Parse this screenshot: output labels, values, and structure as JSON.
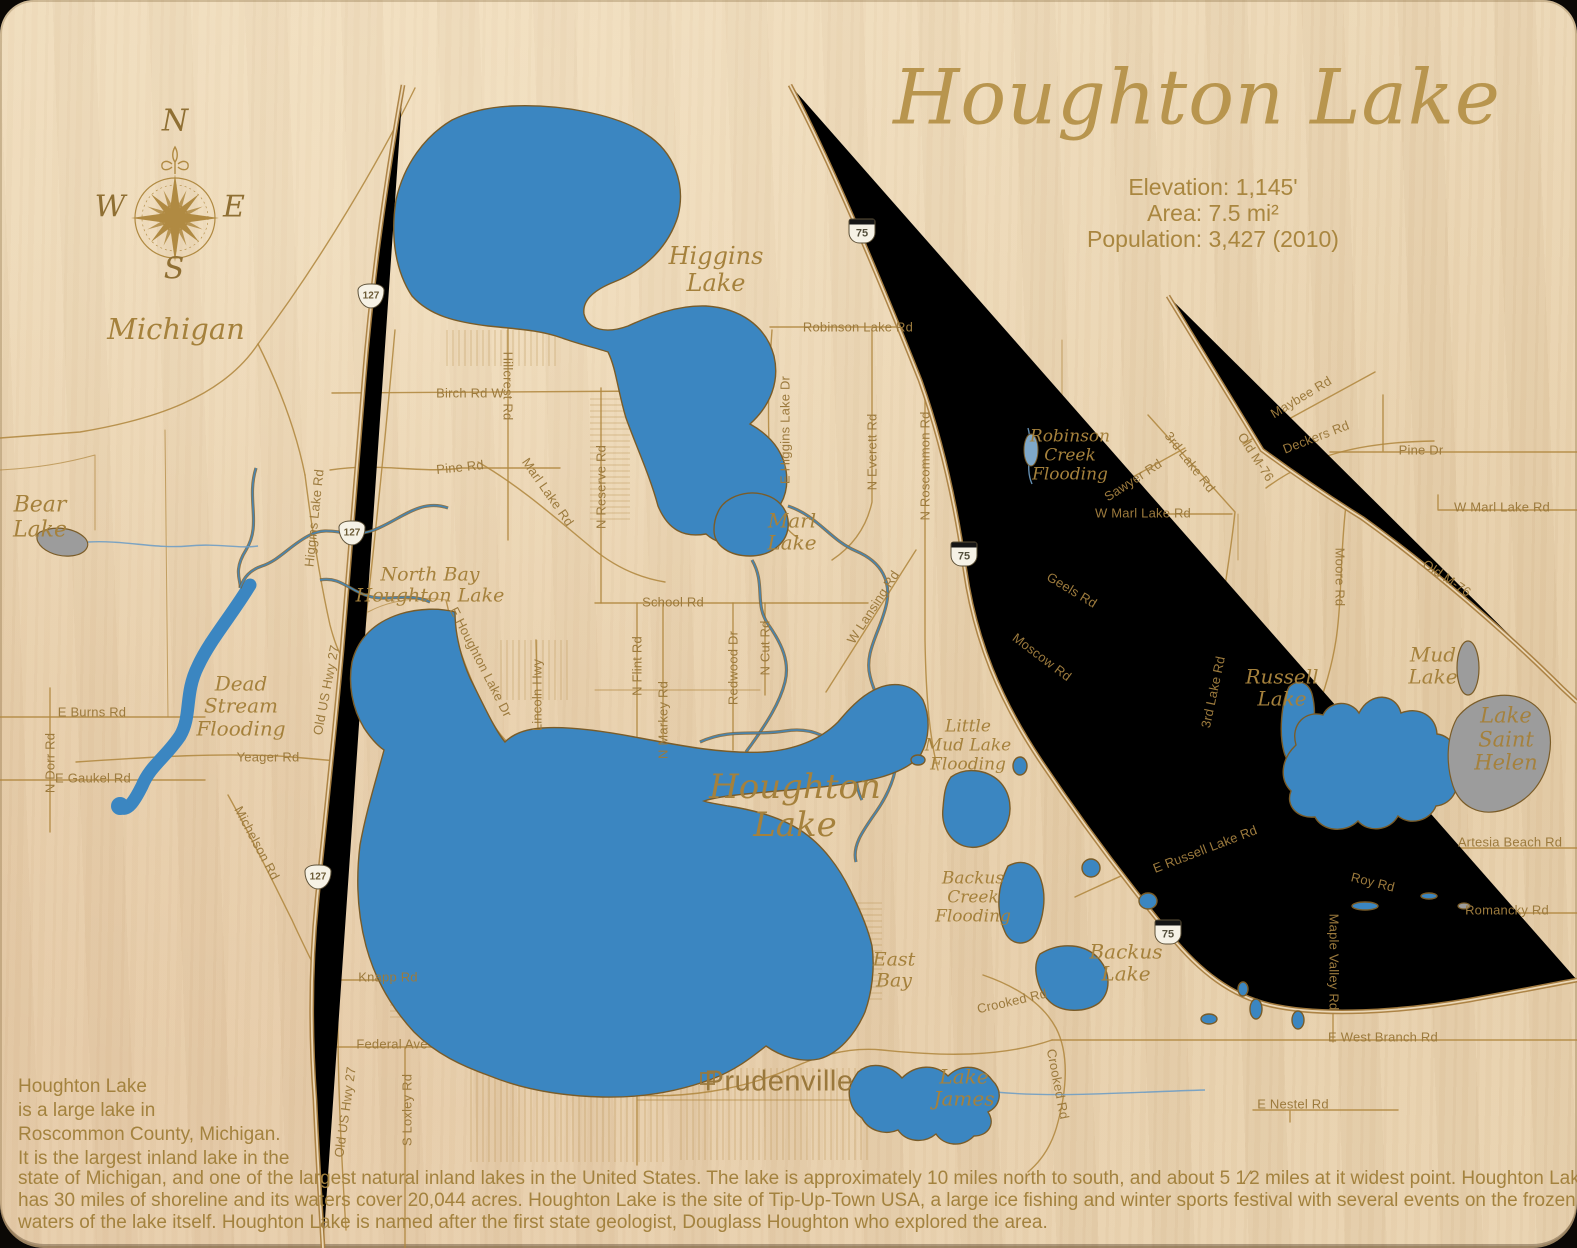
{
  "title": "Houghton Lake",
  "state_label": "Michigan",
  "city_label": "Prudenville",
  "stats": {
    "elevation": "Elevation: 1,145'",
    "area": "Area: 7.5 mi²",
    "population": "Population: 3,427 (2010)"
  },
  "compass": {
    "north": "N",
    "east": "E",
    "south": "S",
    "west": "W"
  },
  "description": {
    "line1": "Houghton Lake",
    "line2": "is a large lake in",
    "line3": "Roscommon County, Michigan.",
    "line4": "It is the largest inland lake in the",
    "line5": "state of Michigan, and one of the largest natural inland lakes in the United States. The lake is approximately 10 miles north to south, and about 5 1⁄2 miles at it widest point. Houghton Lake",
    "line6": "has 30 miles of shoreline and its waters cover 20,044 acres.  Houghton Lake is the site of Tip-Up-Town USA, a large ice fishing and winter sports festival with several events on the frozen",
    "line7": "waters of the lake itself. Houghton Lake is named after the first state geologist, Douglass Houghton who explored the area."
  },
  "colors": {
    "wood": "#e8d2b0",
    "road": "#b1873f",
    "water": "#3b86c1",
    "gray_water": "#9c9c9c",
    "label_gold": "#9c7a3d",
    "title_gold": "#b8954e"
  },
  "road_labels": [
    {
      "text": "Birch Rd W",
      "x": 470,
      "y": 393,
      "rot": 0
    },
    {
      "text": "Hillcrest Rd",
      "x": 508,
      "y": 386,
      "rot": 90
    },
    {
      "text": "Pine Rd",
      "x": 460,
      "y": 467,
      "rot": -6
    },
    {
      "text": "Marl Lake Rd",
      "x": 548,
      "y": 492,
      "rot": 55
    },
    {
      "text": "N Reserve Rd",
      "x": 601,
      "y": 487,
      "rot": -90
    },
    {
      "text": "E Higgins Lake Dr",
      "x": 785,
      "y": 430,
      "rot": -90
    },
    {
      "text": "Robinson Lake Rd",
      "x": 858,
      "y": 327,
      "rot": 0
    },
    {
      "text": "N Everett Rd",
      "x": 872,
      "y": 452,
      "rot": -90
    },
    {
      "text": "N Roscommon Rd",
      "x": 925,
      "y": 466,
      "rot": -90
    },
    {
      "text": "W Lansing Rd",
      "x": 873,
      "y": 607,
      "rot": -57
    },
    {
      "text": "Sawyer Rd",
      "x": 1133,
      "y": 480,
      "rot": -33
    },
    {
      "text": "3rd Lake Rd",
      "x": 1190,
      "y": 462,
      "rot": 52
    },
    {
      "text": "W Marl Lake Rd",
      "x": 1143,
      "y": 513,
      "rot": 0
    },
    {
      "text": "Geels Rd",
      "x": 1072,
      "y": 590,
      "rot": 31
    },
    {
      "text": "Moscow Rd",
      "x": 1042,
      "y": 657,
      "rot": 37
    },
    {
      "text": "Maybee Rd",
      "x": 1301,
      "y": 397,
      "rot": -31
    },
    {
      "text": "Old M-76",
      "x": 1256,
      "y": 457,
      "rot": 57
    },
    {
      "text": "Deckers Rd",
      "x": 1316,
      "y": 437,
      "rot": -21
    },
    {
      "text": "Pine Dr",
      "x": 1421,
      "y": 450,
      "rot": 0
    },
    {
      "text": "W Marl Lake Rd",
      "x": 1502,
      "y": 507,
      "rot": 0
    },
    {
      "text": "Old M-76",
      "x": 1447,
      "y": 578,
      "rot": 34
    },
    {
      "text": "Moore Rd",
      "x": 1340,
      "y": 577,
      "rot": 90
    },
    {
      "text": "3rd Lake Rd",
      "x": 1213,
      "y": 692,
      "rot": -78
    },
    {
      "text": "Higgins Lake Rd",
      "x": 314,
      "y": 518,
      "rot": -84
    },
    {
      "text": "Old US Hwy 27",
      "x": 326,
      "y": 690,
      "rot": -79
    },
    {
      "text": "E Houghton Lake Dr",
      "x": 481,
      "y": 662,
      "rot": 63
    },
    {
      "text": "Lincoln Hwy",
      "x": 537,
      "y": 695,
      "rot": -90
    },
    {
      "text": "N Flint Rd",
      "x": 637,
      "y": 666,
      "rot": -90
    },
    {
      "text": "N Markey Rd",
      "x": 663,
      "y": 720,
      "rot": -90
    },
    {
      "text": "Redwood Dr",
      "x": 733,
      "y": 668,
      "rot": -90
    },
    {
      "text": "N Cut Rd",
      "x": 765,
      "y": 648,
      "rot": -90
    },
    {
      "text": "School Rd",
      "x": 673,
      "y": 602,
      "rot": 0
    },
    {
      "text": "E Burns Rd",
      "x": 92,
      "y": 712,
      "rot": 0
    },
    {
      "text": "N Dorr Rd",
      "x": 50,
      "y": 763,
      "rot": -90
    },
    {
      "text": "E Gaukel Rd",
      "x": 93,
      "y": 778,
      "rot": 0
    },
    {
      "text": "Yeager Rd",
      "x": 268,
      "y": 757,
      "rot": 0
    },
    {
      "text": "Michelson Rd",
      "x": 257,
      "y": 843,
      "rot": 62
    },
    {
      "text": "Knapp Rd",
      "x": 388,
      "y": 977,
      "rot": 0
    },
    {
      "text": "Federal Ave",
      "x": 392,
      "y": 1044,
      "rot": 0
    },
    {
      "text": "Old US Hwy 27",
      "x": 345,
      "y": 1112,
      "rot": -82
    },
    {
      "text": "S Loxley Rd",
      "x": 407,
      "y": 1110,
      "rot": -90
    },
    {
      "text": "E Russell Lake Rd",
      "x": 1205,
      "y": 849,
      "rot": -21
    },
    {
      "text": "Crooked Rd",
      "x": 1012,
      "y": 1001,
      "rot": -13
    },
    {
      "text": "Crooked Rd",
      "x": 1058,
      "y": 1084,
      "rot": 79
    },
    {
      "text": "Roy Rd",
      "x": 1373,
      "y": 882,
      "rot": 14
    },
    {
      "text": "Artesia Beach Rd",
      "x": 1510,
      "y": 842,
      "rot": 0
    },
    {
      "text": "Romancky Rd",
      "x": 1507,
      "y": 910,
      "rot": 0
    },
    {
      "text": "Maple Valley Rd",
      "x": 1334,
      "y": 962,
      "rot": 90
    },
    {
      "text": "E West Branch Rd",
      "x": 1383,
      "y": 1037,
      "rot": 0
    },
    {
      "text": "E Nestel Rd",
      "x": 1293,
      "y": 1104,
      "rot": 0
    }
  ],
  "water_labels": [
    {
      "text": "Higgins\nLake",
      "x": 716,
      "y": 270,
      "size": 24
    },
    {
      "text": "Marl\nLake",
      "x": 792,
      "y": 532,
      "size": 20
    },
    {
      "text": "Bear\nLake",
      "x": 40,
      "y": 518,
      "size": 22
    },
    {
      "text": "Dead\nStream\nFlooding",
      "x": 241,
      "y": 706,
      "size": 20
    },
    {
      "text": "North Bay\nHoughton Lake",
      "x": 430,
      "y": 586,
      "size": 19
    },
    {
      "text": "Houghton\nLake",
      "x": 795,
      "y": 806,
      "size": 34
    },
    {
      "text": "East\nBay",
      "x": 894,
      "y": 971,
      "size": 19
    },
    {
      "text": "Robinson\nCreek\nFlooding",
      "x": 1070,
      "y": 456,
      "size": 17
    },
    {
      "text": "Little\nMud Lake\nFlooding",
      "x": 968,
      "y": 746,
      "size": 17
    },
    {
      "text": "Backus\nCreek\nFlooding",
      "x": 973,
      "y": 898,
      "size": 17
    },
    {
      "text": "Backus\nLake",
      "x": 1126,
      "y": 963,
      "size": 20
    },
    {
      "text": "Lake\nJames",
      "x": 964,
      "y": 1088,
      "size": 20
    },
    {
      "text": "Russell\nLake",
      "x": 1282,
      "y": 688,
      "size": 20
    },
    {
      "text": "Mud\nLake",
      "x": 1433,
      "y": 666,
      "size": 20
    },
    {
      "text": "Lake\nSaint\nHelen",
      "x": 1506,
      "y": 740,
      "size": 21
    }
  ],
  "shields": [
    {
      "cls": "i75",
      "text": "75",
      "x": 862,
      "y": 231
    },
    {
      "cls": "i75",
      "text": "75",
      "x": 964,
      "y": 554
    },
    {
      "cls": "i75",
      "text": "75",
      "x": 1168,
      "y": 932
    },
    {
      "cls": "us127",
      "text": "127",
      "x": 371,
      "y": 296
    },
    {
      "cls": "us127",
      "text": "127",
      "x": 352,
      "y": 533
    },
    {
      "cls": "us127",
      "text": "127",
      "x": 318,
      "y": 877
    }
  ]
}
